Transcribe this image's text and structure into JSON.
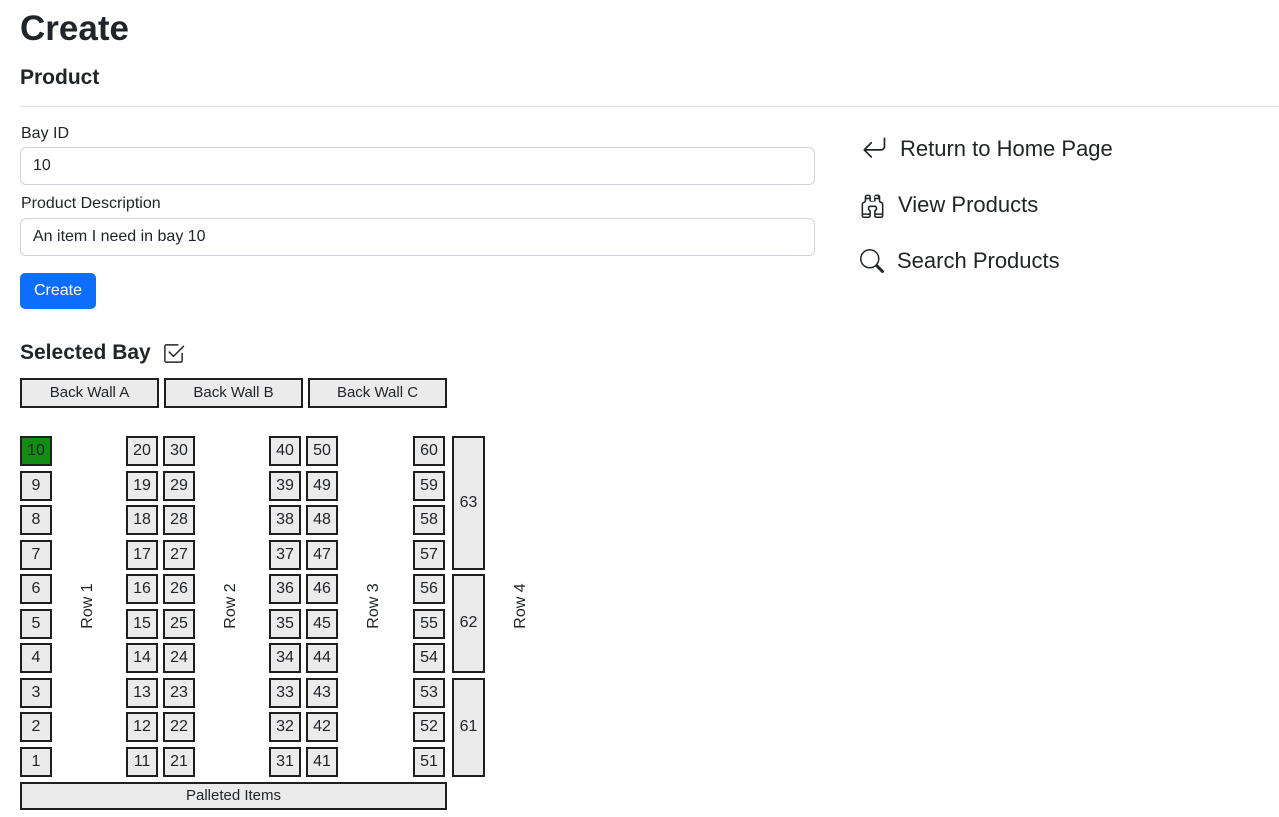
{
  "page": {
    "title": "Create",
    "subtitle": "Product"
  },
  "colors": {
    "primary_button": "#0d6efd",
    "selected_bay_fill": "#128c12",
    "bay_fill": "#ebebeb",
    "bay_border": "#1f1f1f",
    "input_border": "#ced4da",
    "text": "#212529"
  },
  "form": {
    "bay_id": {
      "label": "Bay ID",
      "value": "10"
    },
    "product_description": {
      "label": "Product Description",
      "value": "An item I need in bay 10"
    },
    "create_button_label": "Create"
  },
  "nav_links": [
    {
      "icon": "arrow-return-left-icon",
      "label": "Return to Home Page"
    },
    {
      "icon": "binoculars-icon",
      "label": "View Products"
    },
    {
      "icon": "search-icon",
      "label": "Search Products"
    }
  ],
  "selected_bay": {
    "heading": "Selected Bay",
    "heading_icon": "checkbox-checked-icon",
    "back_wall_buttons": [
      "Back Wall A",
      "Back Wall B",
      "Back Wall C"
    ],
    "selected_bay_id": "10",
    "row_labels": [
      "Row 1",
      "Row 2",
      "Row 3",
      "Row 4"
    ],
    "bay_columns": [
      [
        "10",
        "9",
        "8",
        "7",
        "6",
        "5",
        "4",
        "3",
        "2",
        "1"
      ],
      [
        "20",
        "19",
        "18",
        "17",
        "16",
        "15",
        "14",
        "13",
        "12",
        "11"
      ],
      [
        "30",
        "29",
        "28",
        "27",
        "26",
        "25",
        "24",
        "23",
        "22",
        "21"
      ],
      [
        "40",
        "39",
        "38",
        "37",
        "36",
        "35",
        "34",
        "33",
        "32",
        "31"
      ],
      [
        "50",
        "49",
        "48",
        "47",
        "46",
        "45",
        "44",
        "43",
        "42",
        "41"
      ],
      [
        "60",
        "59",
        "58",
        "57",
        "56",
        "55",
        "54",
        "53",
        "52",
        "51"
      ]
    ],
    "tall_bays": [
      {
        "label": "63",
        "span": 4
      },
      {
        "label": "62",
        "span": 3
      },
      {
        "label": "61",
        "span": 3
      }
    ],
    "palleted_items_label": "Palleted Items"
  }
}
